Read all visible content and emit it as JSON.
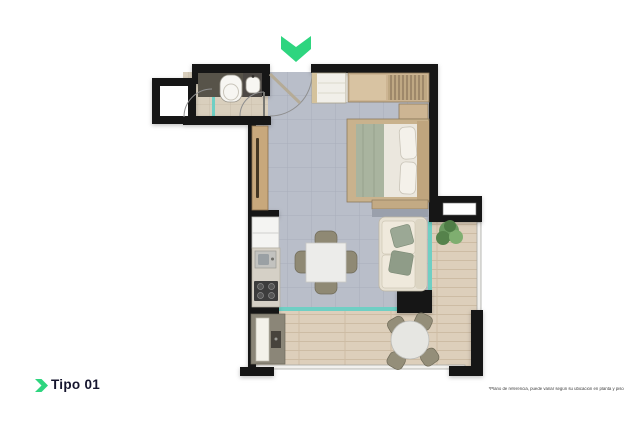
{
  "canvas": {
    "width": 640,
    "height": 427
  },
  "footer": {
    "unit_label": "Tipo 01",
    "disclaimer": "*Plano de referencia, puede variar según su ubicación en planta y piso"
  },
  "entrance_marker": {
    "icon": "chevron-down-arrow",
    "meaning": "entrance"
  },
  "unit_label_icon": "chevron-right-icon",
  "colors": {
    "page_background": "#ffffff",
    "accent_green": "#2ed57f",
    "wall_black": "#161616",
    "tile_floor": "#b9bec9",
    "bathroom_floor": "#d9cfbd",
    "wood_floor": "#ddcfbb",
    "glass_teal": "#6fcfc4",
    "bed_blanket": "#a9b49f",
    "furniture_wood": "#c9ae85"
  }
}
